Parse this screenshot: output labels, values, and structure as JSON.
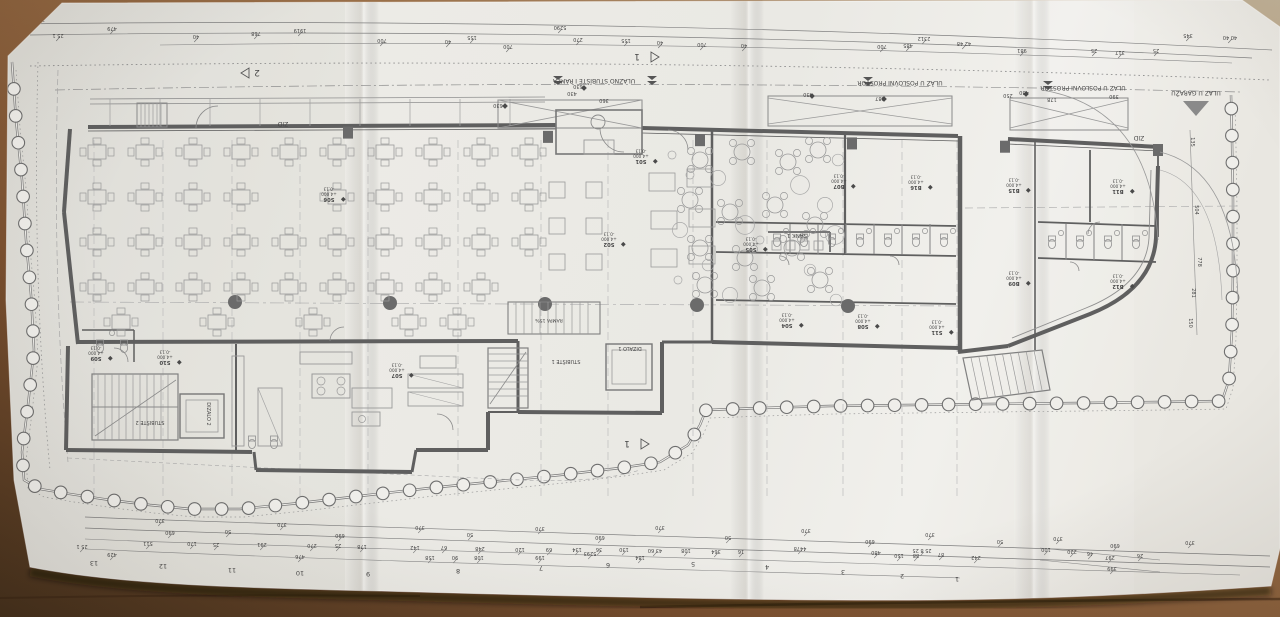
{
  "photo": {
    "paper_color": "#edece7",
    "wood_light": "#bdae93",
    "wood_mid": "#8a5f3a",
    "wood_dark": "#4b331e",
    "ink": "#474747",
    "wall_color": "#5f5f5f"
  },
  "plan": {
    "rotated_180": true,
    "tag_level": "+4.000",
    "tag_offset": "-0.13",
    "entrance_labels": [
      {
        "name": "label-ulazno-stubiste-i-rampa",
        "text": "ULAZNO STUBIŠTE I RAMPA",
        "x": 594,
        "y": 79
      },
      {
        "name": "label-ulaz-u-poslovni-prostor-1",
        "text": "ULAZ U POSLOVNI PROSTOR",
        "x": 900,
        "y": 81
      },
      {
        "name": "label-ulaz-u-poslovni-prostor-2",
        "text": "ULAZ U POSLOVNI PROSTOR",
        "x": 1083,
        "y": 86
      },
      {
        "name": "label-ulaz-u-garazu",
        "text": "ULAZ U GARAŽU",
        "x": 1196,
        "y": 91
      }
    ],
    "feature_labels": [
      {
        "name": "label-sank-1",
        "text": "SANK 1",
        "x": 797,
        "y": 234,
        "s": 5.5
      },
      {
        "name": "label-stubiste-1",
        "text": "STUBIŠTE 1",
        "x": 566,
        "y": 360,
        "s": 5
      },
      {
        "name": "label-dizalo-1",
        "text": "DIZALO 1",
        "x": 630,
        "y": 347,
        "s": 5
      },
      {
        "name": "label-rampa-15",
        "text": "RAMPA 15%",
        "x": 549,
        "y": 319,
        "s": 4.6
      },
      {
        "name": "label-stubiste-2",
        "text": "STUBIŠTE 2",
        "x": 150,
        "y": 421,
        "s": 5
      },
      {
        "name": "label-dizalo-2",
        "text": "DIZALO 2",
        "x": 207,
        "y": 414,
        "s": 5,
        "rot": 90
      },
      {
        "name": "label-zid-1",
        "text": "ZID",
        "x": 283,
        "y": 122,
        "s": 6
      },
      {
        "name": "label-zid-2",
        "text": "ZID",
        "x": 1139,
        "y": 136,
        "s": 6
      }
    ],
    "section_markers": [
      {
        "label": "2",
        "x": 257,
        "y": 73,
        "dir": "left"
      },
      {
        "label": "1",
        "x": 637,
        "y": 57,
        "dir": "right"
      },
      {
        "label": "1",
        "x": 627,
        "y": 444,
        "dir": "right"
      }
    ],
    "room_tags": [
      {
        "code": "S01",
        "x": 641,
        "y": 152
      },
      {
        "code": "S02",
        "x": 609,
        "y": 235
      },
      {
        "code": "S05",
        "x": 751,
        "y": 240
      },
      {
        "code": "S06",
        "x": 329,
        "y": 190
      },
      {
        "code": "S07",
        "x": 397,
        "y": 366
      },
      {
        "code": "S09",
        "x": 96,
        "y": 349
      },
      {
        "code": "S10",
        "x": 165,
        "y": 353
      },
      {
        "code": "S04",
        "x": 787,
        "y": 316
      },
      {
        "code": "S08",
        "x": 863,
        "y": 317
      },
      {
        "code": "S11",
        "x": 937,
        "y": 323
      },
      {
        "code": "B07",
        "x": 839,
        "y": 177
      },
      {
        "code": "B16",
        "x": 916,
        "y": 178
      },
      {
        "code": "B15",
        "x": 1014,
        "y": 181
      },
      {
        "code": "B11",
        "x": 1118,
        "y": 182
      },
      {
        "code": "B09",
        "x": 1014,
        "y": 274
      },
      {
        "code": "B12",
        "x": 1118,
        "y": 277
      }
    ],
    "grid_numbers": [
      {
        "n": "13",
        "x": 94,
        "y": 561
      },
      {
        "n": "12",
        "x": 163,
        "y": 564
      },
      {
        "n": "11",
        "x": 232,
        "y": 568
      },
      {
        "n": "10",
        "x": 300,
        "y": 571
      },
      {
        "n": "9",
        "x": 368,
        "y": 572
      },
      {
        "n": "8",
        "x": 458,
        "y": 569
      },
      {
        "n": "7",
        "x": 541,
        "y": 566
      },
      {
        "n": "6",
        "x": 608,
        "y": 563
      },
      {
        "n": "5",
        "x": 693,
        "y": 562
      },
      {
        "n": "4",
        "x": 767,
        "y": 565
      },
      {
        "n": "3",
        "x": 843,
        "y": 570
      },
      {
        "n": "2",
        "x": 902,
        "y": 574
      },
      {
        "n": "1",
        "x": 957,
        "y": 577
      }
    ],
    "dim_top": [
      {
        "t": "46 40",
        "x": 16,
        "y": 20
      },
      {
        "t": "230",
        "x": 40,
        "y": 18
      },
      {
        "t": "25 1",
        "x": 58,
        "y": 34
      },
      {
        "t": "479",
        "x": 112,
        "y": 27
      },
      {
        "t": "40",
        "x": 196,
        "y": 35
      },
      {
        "t": "768",
        "x": 256,
        "y": 32
      },
      {
        "t": "1919",
        "x": 300,
        "y": 29
      },
      {
        "t": "700",
        "x": 382,
        "y": 39
      },
      {
        "t": "40",
        "x": 448,
        "y": 40
      },
      {
        "t": "155",
        "x": 472,
        "y": 36
      },
      {
        "t": "700",
        "x": 508,
        "y": 45
      },
      {
        "t": "5290",
        "x": 560,
        "y": 26
      },
      {
        "t": "270",
        "x": 578,
        "y": 38
      },
      {
        "t": "155",
        "x": 626,
        "y": 39
      },
      {
        "t": "40",
        "x": 660,
        "y": 41
      },
      {
        "t": "700",
        "x": 702,
        "y": 43
      },
      {
        "t": "40",
        "x": 744,
        "y": 44
      },
      {
        "t": "700",
        "x": 882,
        "y": 45
      },
      {
        "t": "485",
        "x": 908,
        "y": 44
      },
      {
        "t": "2312",
        "x": 924,
        "y": 37
      },
      {
        "t": "42 48",
        "x": 964,
        "y": 42
      },
      {
        "t": "981",
        "x": 1022,
        "y": 49
      },
      {
        "t": "25",
        "x": 1094,
        "y": 49
      },
      {
        "t": "317",
        "x": 1120,
        "y": 51
      },
      {
        "t": "25",
        "x": 1156,
        "y": 49
      },
      {
        "t": "345",
        "x": 1188,
        "y": 34
      },
      {
        "t": "40 40",
        "x": 1230,
        "y": 36
      },
      {
        "t": "630",
        "x": 498,
        "y": 104
      },
      {
        "t": "430",
        "x": 572,
        "y": 92
      },
      {
        "t": "630",
        "x": 578,
        "y": 85
      },
      {
        "t": "360",
        "x": 604,
        "y": 99
      },
      {
        "t": "430",
        "x": 808,
        "y": 93
      },
      {
        "t": "287",
        "x": 880,
        "y": 97
      },
      {
        "t": "250",
        "x": 1008,
        "y": 94
      },
      {
        "t": "430",
        "x": 1024,
        "y": 91
      },
      {
        "t": "178",
        "x": 1052,
        "y": 98
      },
      {
        "t": "390",
        "x": 1114,
        "y": 95
      }
    ],
    "dim_bottom": [
      {
        "t": "370",
        "x": 160,
        "y": 519
      },
      {
        "t": "370",
        "x": 282,
        "y": 523
      },
      {
        "t": "370",
        "x": 420,
        "y": 526
      },
      {
        "t": "370",
        "x": 540,
        "y": 527
      },
      {
        "t": "370",
        "x": 660,
        "y": 526
      },
      {
        "t": "370",
        "x": 806,
        "y": 529
      },
      {
        "t": "370",
        "x": 930,
        "y": 533
      },
      {
        "t": "370",
        "x": 1058,
        "y": 537
      },
      {
        "t": "370",
        "x": 1190,
        "y": 541
      },
      {
        "t": "690",
        "x": 170,
        "y": 531
      },
      {
        "t": "50",
        "x": 228,
        "y": 530
      },
      {
        "t": "690",
        "x": 340,
        "y": 534
      },
      {
        "t": "50",
        "x": 470,
        "y": 533
      },
      {
        "t": "690",
        "x": 600,
        "y": 536
      },
      {
        "t": "50",
        "x": 728,
        "y": 536
      },
      {
        "t": "690",
        "x": 870,
        "y": 540
      },
      {
        "t": "50",
        "x": 1000,
        "y": 540
      },
      {
        "t": "690",
        "x": 1115,
        "y": 544
      },
      {
        "t": "25 1",
        "x": 82,
        "y": 545
      },
      {
        "t": "511",
        "x": 148,
        "y": 542
      },
      {
        "t": "170",
        "x": 192,
        "y": 542
      },
      {
        "t": "25",
        "x": 216,
        "y": 543
      },
      {
        "t": "291",
        "x": 262,
        "y": 543
      },
      {
        "t": "270",
        "x": 312,
        "y": 544
      },
      {
        "t": "25",
        "x": 338,
        "y": 544
      },
      {
        "t": "178",
        "x": 362,
        "y": 545
      },
      {
        "t": "142",
        "x": 415,
        "y": 546
      },
      {
        "t": "67",
        "x": 444,
        "y": 546
      },
      {
        "t": "248",
        "x": 480,
        "y": 547
      },
      {
        "t": "120",
        "x": 520,
        "y": 548
      },
      {
        "t": "69",
        "x": 549,
        "y": 548
      },
      {
        "t": "134",
        "x": 577,
        "y": 548
      },
      {
        "t": "36",
        "x": 599,
        "y": 548
      },
      {
        "t": "130",
        "x": 624,
        "y": 548
      },
      {
        "t": "43 60",
        "x": 655,
        "y": 549
      },
      {
        "t": "108",
        "x": 686,
        "y": 549
      },
      {
        "t": "364",
        "x": 716,
        "y": 550
      },
      {
        "t": "16",
        "x": 741,
        "y": 550
      },
      {
        "t": "429",
        "x": 112,
        "y": 553
      },
      {
        "t": "476",
        "x": 300,
        "y": 555
      },
      {
        "t": "158",
        "x": 430,
        "y": 556
      },
      {
        "t": "90",
        "x": 455,
        "y": 556
      },
      {
        "t": "108",
        "x": 479,
        "y": 556
      },
      {
        "t": "199",
        "x": 540,
        "y": 556
      },
      {
        "t": "5293",
        "x": 590,
        "y": 552
      },
      {
        "t": "184",
        "x": 640,
        "y": 556
      },
      {
        "t": "4478",
        "x": 800,
        "y": 547
      },
      {
        "t": "25 8 25",
        "x": 922,
        "y": 549
      },
      {
        "t": "87",
        "x": 941,
        "y": 553
      },
      {
        "t": "480",
        "x": 876,
        "y": 551
      },
      {
        "t": "150",
        "x": 899,
        "y": 554
      },
      {
        "t": "88",
        "x": 916,
        "y": 554
      },
      {
        "t": "242",
        "x": 976,
        "y": 556
      },
      {
        "t": "100",
        "x": 1046,
        "y": 548
      },
      {
        "t": "220",
        "x": 1072,
        "y": 550
      },
      {
        "t": "46",
        "x": 1090,
        "y": 552
      },
      {
        "t": "297",
        "x": 1110,
        "y": 556
      },
      {
        "t": "26",
        "x": 1140,
        "y": 554
      },
      {
        "t": "399",
        "x": 1112,
        "y": 567
      }
    ],
    "dim_right": [
      {
        "t": "135",
        "x": 1191,
        "y": 142
      },
      {
        "t": "504",
        "x": 1195,
        "y": 210
      },
      {
        "t": "778",
        "x": 1198,
        "y": 262
      },
      {
        "t": "281",
        "x": 1192,
        "y": 293
      },
      {
        "t": "150",
        "x": 1189,
        "y": 323
      }
    ]
  }
}
